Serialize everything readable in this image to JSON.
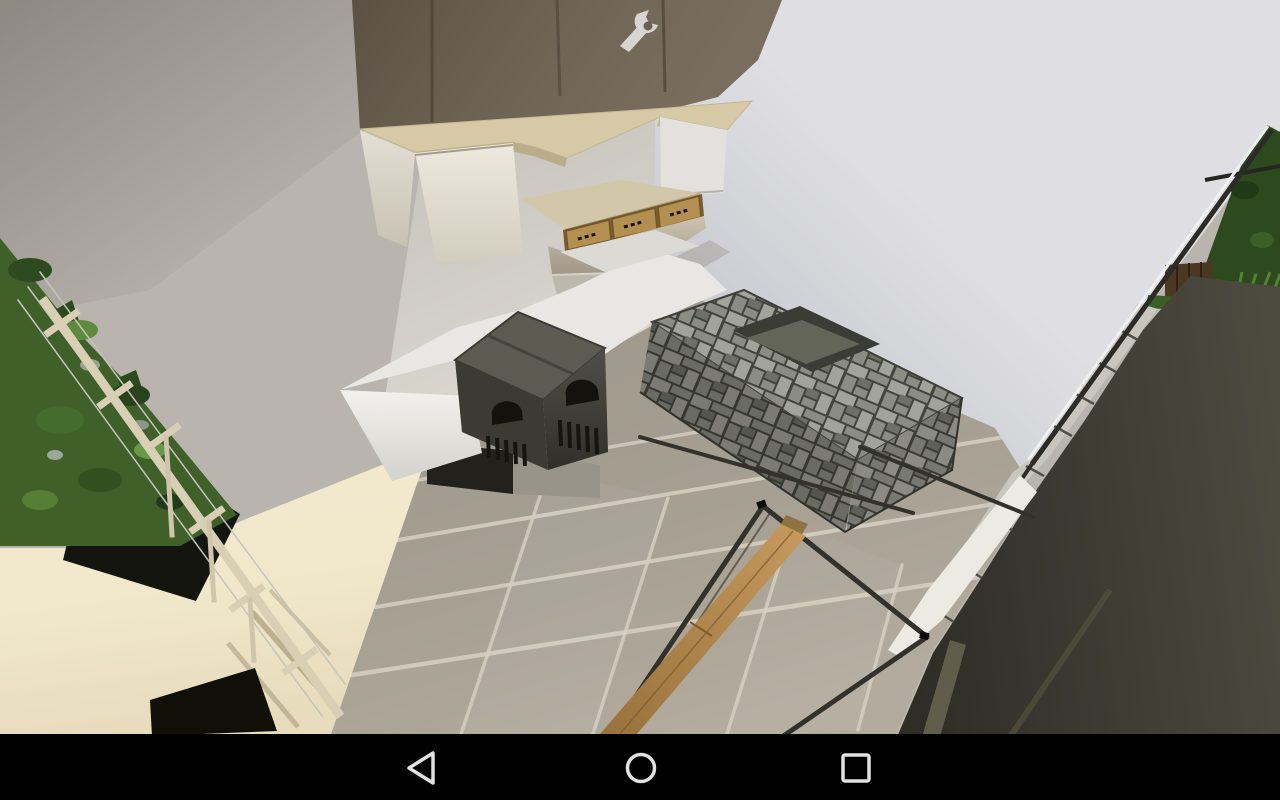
{
  "scene": {
    "game_style": "voxel-sandbox screenshot",
    "setting": "modern kitchen interior viewed from above",
    "objects": [
      "hanging sandstone cabinet with birch trapdoor fronts",
      "wall item frame with wrench",
      "double furnace stove in white counter",
      "stone brick sink counter",
      "tiled stone floor",
      "birch fence stair railing with wires",
      "leaf hedge",
      "glass pane partitions",
      "wooden bench plank",
      "dark roof plane and exterior leaves"
    ]
  },
  "navigation_bar": {
    "buttons": [
      {
        "id": "back",
        "shape": "triangle-left"
      },
      {
        "id": "home",
        "shape": "circle"
      },
      {
        "id": "recents",
        "shape": "square"
      }
    ]
  },
  "palette": {
    "wall_gray": "#b9b5ae",
    "wall_white": "#dfdfe3",
    "ceiling_dark": "#6b6152",
    "wrench": "#d6d5d1",
    "sandstone_top": "#d5c9a6",
    "shelf": "#d2c7a8",
    "trapdoor": "#b3904f",
    "trapdoor_frame": "#7a5f30",
    "counter_white": "#e8e7e3",
    "furnace_top": "#5c5b51",
    "furnace_opening": "#13120d",
    "stone_light": "#a2a39a",
    "stone_mid": "#8b8c84",
    "stone_dark": "#6e6f66",
    "stone_gap": "#43443c",
    "floor_tile": "#b3ac9e",
    "floor_grout": "#d7d1c2",
    "cream_wall": "#efe4c8",
    "black_opening": "#15150f",
    "leaves": "#3f6029",
    "leaves_dark": "#2c4a1e",
    "leaves_light": "#69984a",
    "railing": "#d9cfb4",
    "wire": "#c4c4bd",
    "dark_plane": "#46433a",
    "dark_plane_deep": "#2f2d26",
    "slab_band": "#c9c6bd",
    "pane_frame": "#33312b",
    "bench_top": "#b9894d",
    "bench_side": "#6e5127",
    "wood_block": "#4b3823",
    "sliver_white": "#eceae2",
    "navbar_bg": "#000000",
    "navbar_icon": "#e2e2e2"
  }
}
